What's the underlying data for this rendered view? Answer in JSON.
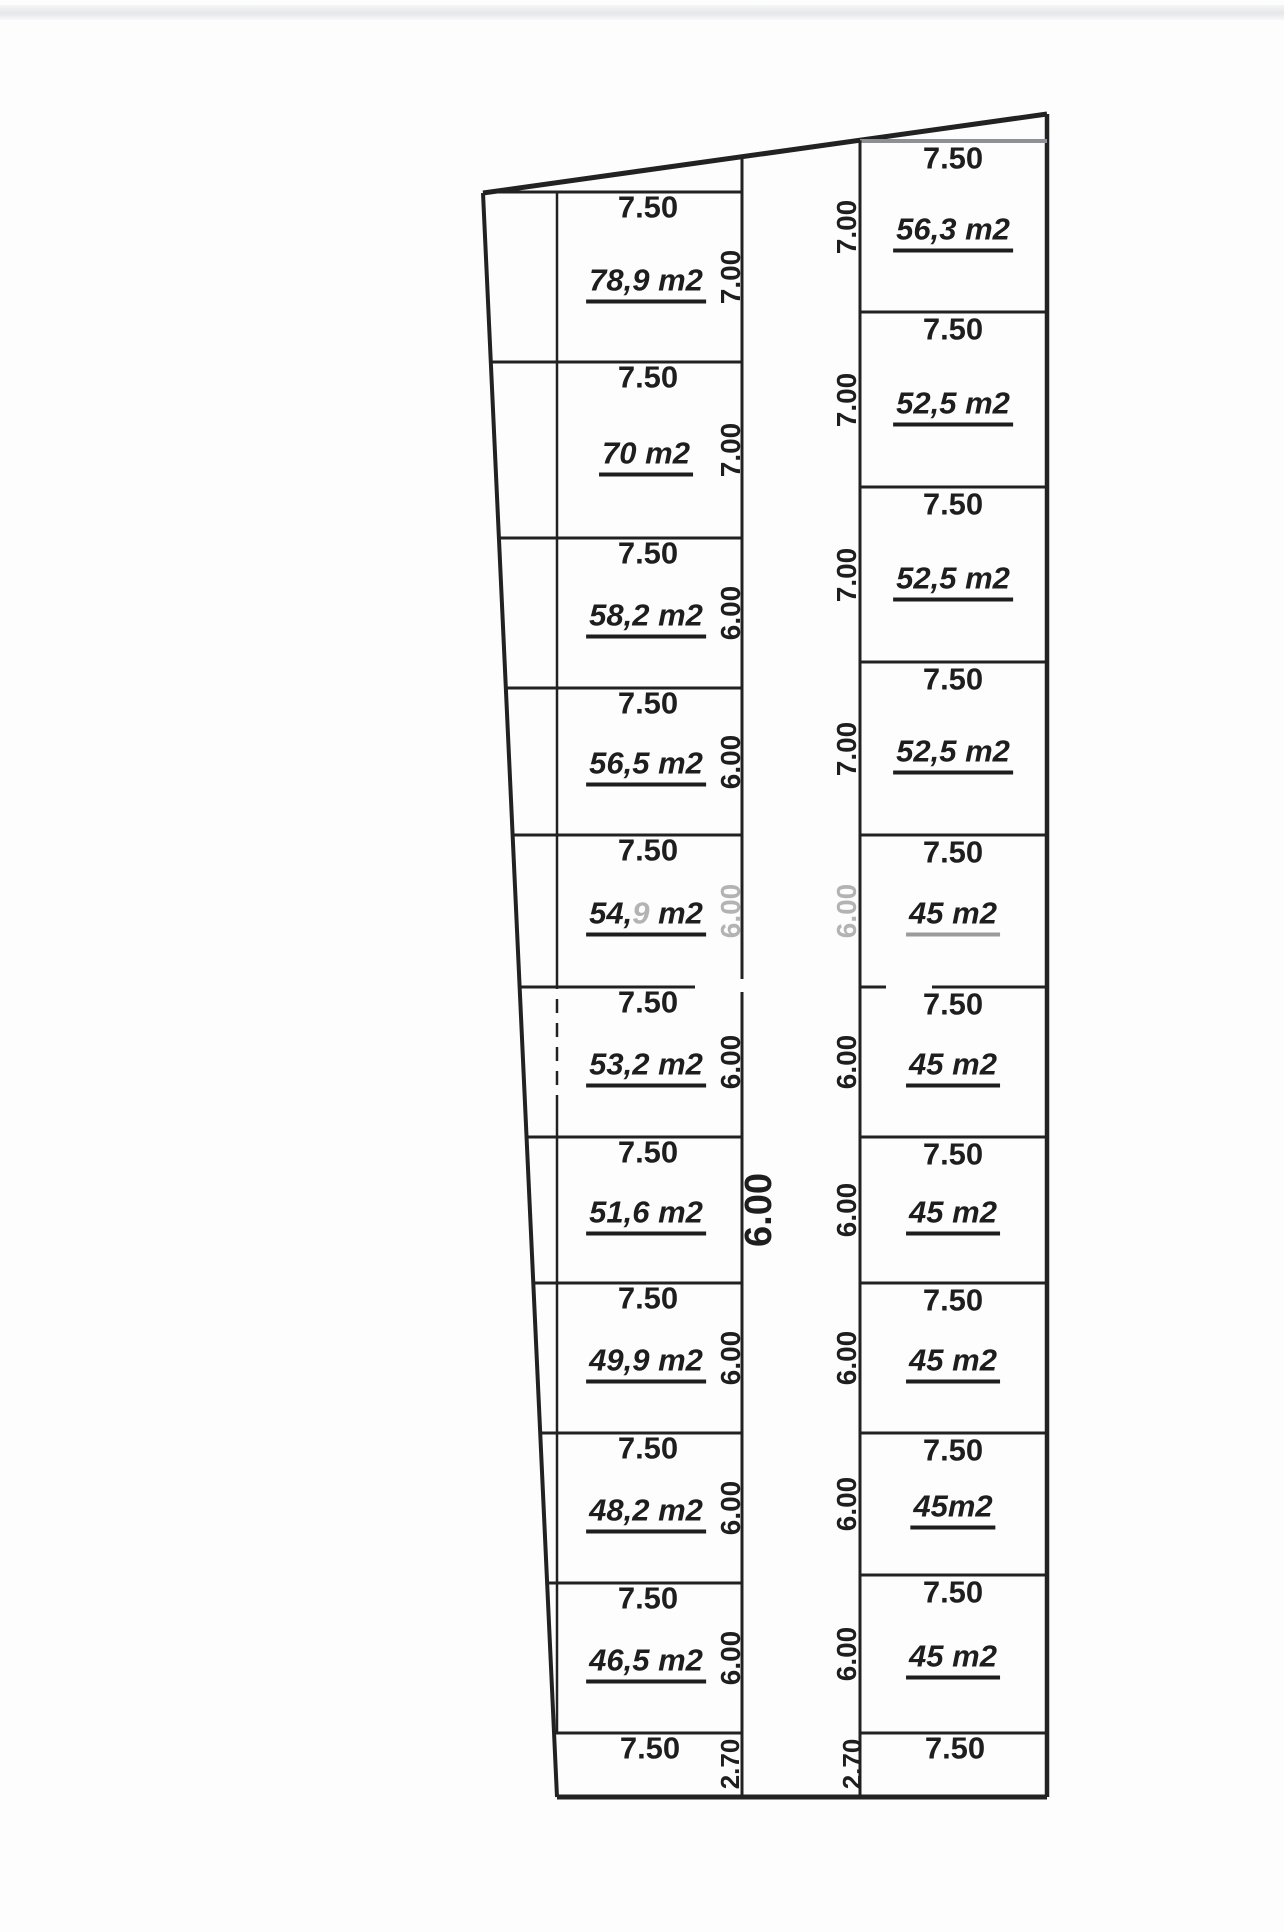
{
  "canvas": {
    "width": 1284,
    "height": 1932,
    "background": "#fdfdfe",
    "ink": "#222222",
    "gray_line_color": "#8d9095",
    "faded_text_color": "#b3b3b3",
    "top_band_color": "#e6e7e9"
  },
  "plan": {
    "outline": {
      "top_left": [
        483,
        193
      ],
      "top_right": [
        1047,
        114
      ],
      "bottom_left": [
        557,
        1797
      ],
      "bottom_right": [
        1047,
        1797
      ]
    },
    "road": {
      "x_left": 742,
      "x_right": 860,
      "width_label": "6.00",
      "width_label_pos": [
        759,
        1210
      ],
      "bottom_left_label": "2.70",
      "bottom_left_label_pos": [
        730,
        1764
      ],
      "bottom_right_label": "2.70",
      "bottom_right_label_pos": [
        852,
        1764
      ]
    },
    "left_column": {
      "x_left": 557,
      "x_right": 742,
      "top_y": 192,
      "strip_top_y": 1733,
      "bottom_y": 1797,
      "strip_width_label": "7.50",
      "plots": [
        {
          "width_label": "7.50",
          "area_label": "78,9 m2",
          "depth_label": "7.00",
          "y_top": 192,
          "y_bottom": 362
        },
        {
          "width_label": "7.50",
          "area_label": "70 m2",
          "depth_label": "7.00",
          "y_top": 362,
          "y_bottom": 538
        },
        {
          "width_label": "7.50",
          "area_label": "58,2 m2",
          "depth_label": "6.00",
          "y_top": 538,
          "y_bottom": 688
        },
        {
          "width_label": "7.50",
          "area_label": "56,5 m2",
          "depth_label": "6.00",
          "y_top": 688,
          "y_bottom": 835
        },
        {
          "width_label": "7.50",
          "area_label": "54,9 m2",
          "area_label_parts": [
            {
              "t": "54,",
              "faded": false
            },
            {
              "t": "9",
              "faded": true
            },
            {
              "t": " m2",
              "faded": false
            }
          ],
          "depth_label": "6.00",
          "depth_faded": true,
          "y_top": 835,
          "y_bottom": 987
        },
        {
          "width_label": "7.50",
          "area_label": "53,2 m2",
          "depth_label": "6.00",
          "y_top": 987,
          "y_bottom": 1137
        },
        {
          "width_label": "7.50",
          "area_label": "51,6 m2",
          "depth_label": "",
          "y_top": 1137,
          "y_bottom": 1283
        },
        {
          "width_label": "7.50",
          "area_label": "49,9 m2",
          "depth_label": "6.00",
          "y_top": 1283,
          "y_bottom": 1433
        },
        {
          "width_label": "7.50",
          "area_label": "48,2 m2",
          "depth_label": "6.00",
          "y_top": 1433,
          "y_bottom": 1583
        },
        {
          "width_label": "7.50",
          "area_label": "46,5 m2",
          "depth_label": "6.00",
          "y_top": 1583,
          "y_bottom": 1733
        }
      ]
    },
    "right_column": {
      "x_left": 860,
      "x_right": 1047,
      "top_y": 141,
      "strip_top_y": 1733,
      "bottom_y": 1797,
      "strip_width_label": "7.50",
      "plots": [
        {
          "width_label": "7.50",
          "area_label": "56,3 m2",
          "depth_label": "7.00",
          "y_top": 141,
          "y_bottom": 312
        },
        {
          "width_label": "7.50",
          "area_label": "52,5 m2",
          "depth_label": "7.00",
          "y_top": 312,
          "y_bottom": 487
        },
        {
          "width_label": "7.50",
          "area_label": "52,5 m2",
          "depth_label": "7.00",
          "y_top": 487,
          "y_bottom": 662
        },
        {
          "width_label": "7.50",
          "area_label": "52,5 m2",
          "depth_label": "7.00",
          "y_top": 662,
          "y_bottom": 835
        },
        {
          "width_label": "7.50",
          "area_label": "45 m2",
          "depth_label": "6.00",
          "depth_faded": true,
          "underline_faded": true,
          "y_top": 835,
          "y_bottom": 987
        },
        {
          "width_label": "7.50",
          "area_label": "45 m2",
          "depth_label": "6.00",
          "y_top": 987,
          "y_bottom": 1137
        },
        {
          "width_label": "7.50",
          "area_label": "45 m2",
          "depth_label": "6.00",
          "y_top": 1137,
          "y_bottom": 1283
        },
        {
          "width_label": "7.50",
          "area_label": "45 m2",
          "depth_label": "6.00",
          "y_top": 1283,
          "y_bottom": 1433
        },
        {
          "width_label": "7.50",
          "area_label": "45m2",
          "depth_label": "6.00",
          "y_top": 1433,
          "y_bottom": 1575
        },
        {
          "width_label": "7.50",
          "area_label": "45 m2",
          "depth_label": "6.00",
          "y_top": 1575,
          "y_bottom": 1733
        }
      ]
    }
  }
}
